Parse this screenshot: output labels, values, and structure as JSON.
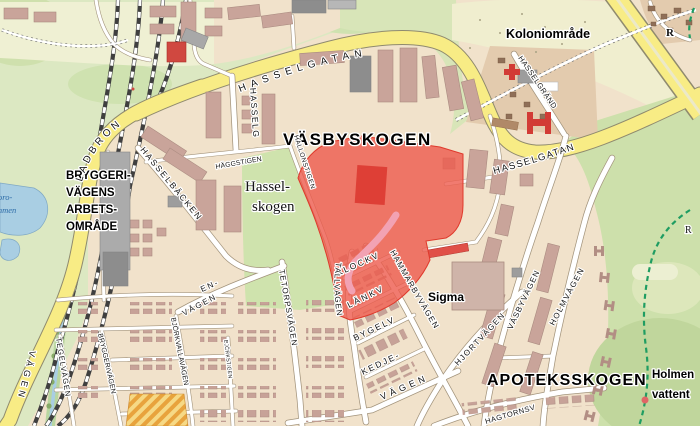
{
  "map": {
    "area_labels": {
      "vasbyskogen": "VÄSBYSKOGEN",
      "apoteksskogen": "APOTEKSSKOGEN",
      "koloniomrade": "Koloniområde",
      "sigma": "Sigma",
      "hasselskogen": [
        "Hassel-",
        "skogen"
      ],
      "bryggeri": [
        "BRYGGERI-",
        "VÄGENS",
        "ARBETS-",
        "OMRÅDE"
      ],
      "holmen": [
        "Holmen",
        "vattent"
      ],
      "r_top": "R",
      "r_mid": "R",
      "water_fragments": [
        "oro-",
        "mmen"
      ]
    },
    "street_labels": {
      "hasselgatan_west": "HASSELGATAN",
      "hasselgatan_east": "HASSELGATAN",
      "ladbron": "LADBRON",
      "hasselg": "HASSELG",
      "haggstigen": "HÄGGSTIGEN",
      "hallonstigen": "HALLONSTIGEN",
      "hasselbacken": "HASSELBÄCKEN",
      "hasselgrand": "HASSELGRÄND",
      "klockv": "KLOCKV",
      "lankv": "LÄNKV",
      "bygelv": "BYGELV",
      "kedje": "KEDJE-",
      "kedje_vagen": "VÄGEN",
      "hammarbyvagen": "HAMMARBYVÄGEN",
      "tallvagen": "TALLVÄGEN",
      "tetorpsvagen": "TETORPSVÄGEN",
      "en": "EN-",
      "en_vagen": "VÄGEN",
      "bjorkvallavagen": "BJÖRKVALLAVÄGEN",
      "bjorkstigen": "BJÖRKSTIGEN",
      "bryggerivagen": "BRYGGERIVÄGEN",
      "tegelvagen": "TEGELVÄGEN",
      "vagen_west": "VÄGEN",
      "hjortvagen": "HJORTVÄGEN",
      "vasbyvagen": "VÄSBYVÄGEN",
      "holmvagen": "HOLMVÄGEN",
      "hagtornsv": "HAGTORNSV"
    },
    "colors": {
      "highlight": "#EE5A4C",
      "highlight_building": "#DB3A31",
      "highlight_path": "#F2A2B3",
      "road_major": "#F8EC85",
      "water": "#A9CEE3",
      "trail_green": "#1F9D62",
      "forest": "#CDE0AB"
    }
  }
}
